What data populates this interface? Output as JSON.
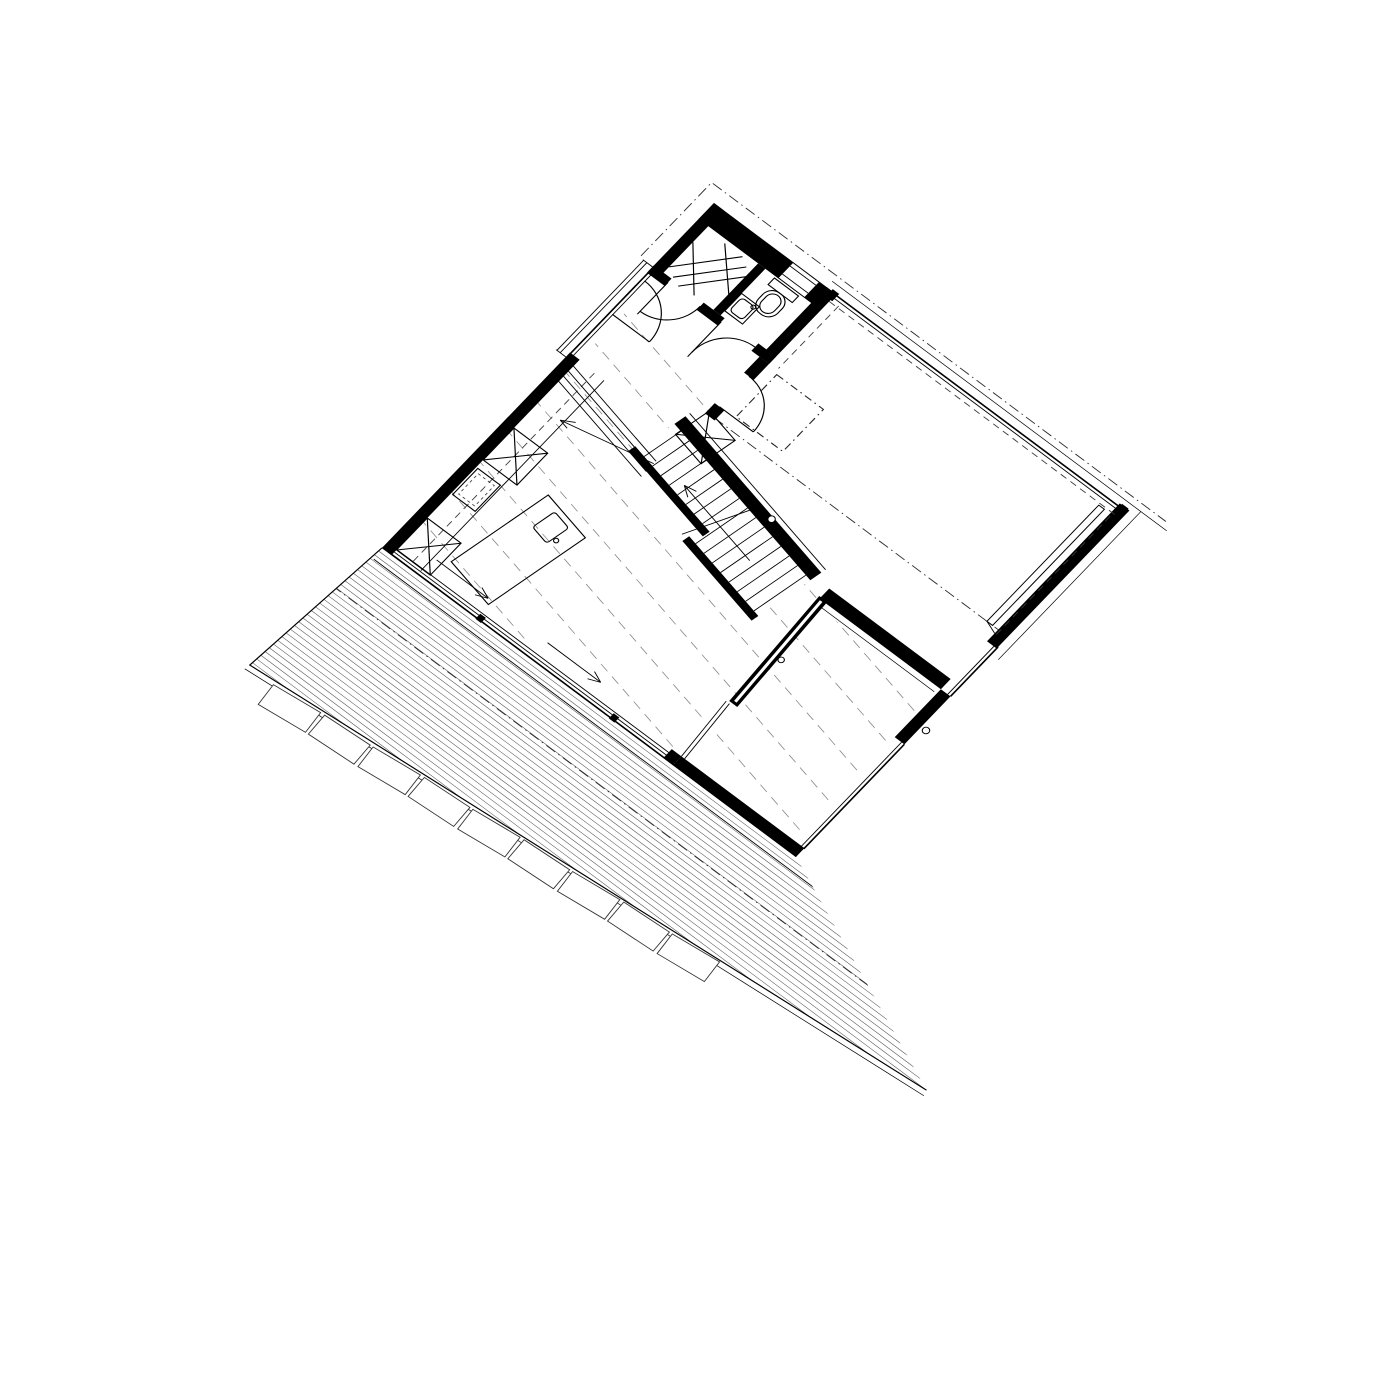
{
  "drawing": {
    "kind": "architectural-floor-plan",
    "paper_color": "#ffffff",
    "ink_color": "#000000",
    "faint_line_color": "#8a8a8a",
    "rotation_deg": 36.7,
    "matrix": [
      0.804,
      0.6,
      -0.699,
      0.726,
      714,
      203
    ],
    "features": [
      "bathroom-shower",
      "wc-toilet",
      "wc-sink",
      "entry-door",
      "hall-stair",
      "skylight-dashed-square",
      "studio-room",
      "kitchen-counter",
      "tall-cabinet-x",
      "kitchen-island-sink",
      "pocket-door-partition",
      "living-room",
      "sliding-glass-facade",
      "parked-sliding-panel",
      "timber-deck",
      "stone-step-band",
      "roof-overhang-dashdot"
    ]
  },
  "deck": {
    "polygon": "0,475 515,475 772,584 -14,648",
    "hatch": {
      "y_start": 479.5,
      "y_end": 645,
      "spacing": 5.5,
      "x1": -60,
      "x2": 800
    },
    "step_line_y": 489,
    "dashdot_y": 535,
    "tiles": {
      "count": 9,
      "start": 58,
      "spacing": 58,
      "w": 54,
      "h": 25,
      "edge_x": -14,
      "edge_y": 650,
      "edge_angle_deg": -4.8,
      "offset": 14,
      "jitter": 1.4
    }
  },
  "floorboards": {
    "angle_deg": 12,
    "y_start": 138,
    "spacing": 41,
    "count": 14,
    "x1": -10,
    "len": 580,
    "dash": "10 7"
  },
  "stair": {
    "origin": [
      128,
      188
    ],
    "angle_deg": 12,
    "tread_count": 16,
    "tread_start": 10,
    "tread_step": 13,
    "q_inner": 13,
    "q_upper": 56,
    "q_lower": 74,
    "landing_lines": {
      "count": 4,
      "x": 8,
      "y0": 214,
      "dy": 7,
      "len": 133
    }
  },
  "slide_arrows": [
    {
      "x1": 48,
      "y1": 452,
      "x2": 112,
      "y2": 452
    },
    {
      "x1": 186,
      "y1": 452,
      "x2": 252,
      "y2": 452
    }
  ],
  "mullions": [
    {
      "x": 117,
      "y": 469
    },
    {
      "x": 283,
      "y": 469
    }
  ],
  "circles": [
    {
      "cx": 262,
      "cy": 219,
      "r": 3.5
    },
    {
      "cx": 521,
      "cy": 296,
      "r": 3.5
    },
    {
      "cx": 367,
      "cy": 326,
      "r": 3.0
    }
  ]
}
